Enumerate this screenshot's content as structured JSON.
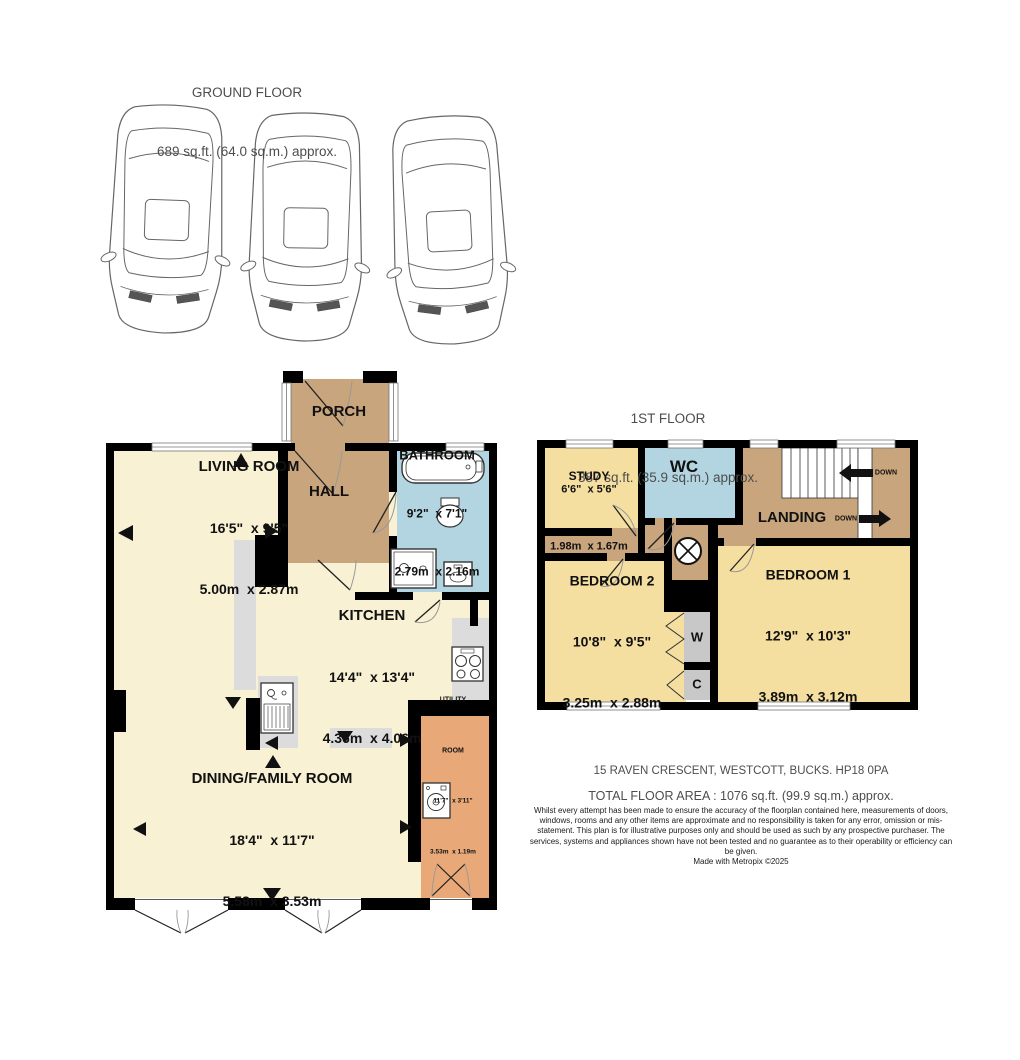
{
  "ground_floor": {
    "title": "GROUND FLOOR",
    "area_label": "689 sq.ft. (64.0 sq.m.) approx.",
    "rooms": {
      "porch": {
        "name": "PORCH"
      },
      "hall": {
        "name": "HALL"
      },
      "bathroom": {
        "name": "BATHROOM",
        "dims_imperial": "9'2\"  x 7'1\"",
        "dims_metric": "2.79m  x 2.16m"
      },
      "living_room": {
        "name": "LIVING ROOM",
        "dims_imperial": "16'5\"  x 9'5\"",
        "dims_metric": "5.00m  x 2.87m"
      },
      "kitchen": {
        "name": "KITCHEN",
        "dims_imperial": "14'4\"  x 13'4\"",
        "dims_metric": "4.36m  x 4.06m"
      },
      "dining_family_room": {
        "name": "DINING/FAMILY ROOM",
        "dims_imperial": "18'4\"  x 11'7\"",
        "dims_metric": "5.58m  x 3.53m"
      },
      "utility_room": {
        "name_line1": "UTILITY",
        "name_line2": "ROOM",
        "dims_imperial": "11'7\"  x 3'11\"",
        "dims_metric": "3.53m  x 1.19m"
      }
    }
  },
  "first_floor": {
    "title": "1ST FLOOR",
    "area_label": "387 sq.ft. (35.9 sq.m.) approx.",
    "rooms": {
      "study": {
        "name": "STUDY",
        "dims_imperial": "6'6\"  x 5'6\"",
        "dims_metric": "1.98m  x 1.67m"
      },
      "wc": {
        "name": "WC"
      },
      "landing": {
        "name": "LANDING"
      },
      "bedroom_2": {
        "name": "BEDROOM 2",
        "dims_imperial": "10'8\"  x 9'5\"",
        "dims_metric": "3.25m  x 2.88m"
      },
      "bedroom_1": {
        "name": "BEDROOM 1",
        "dims_imperial": "12'9\"  x 10'3\"",
        "dims_metric": "3.89m  x 3.12m"
      },
      "wardrobe": {
        "name": "W"
      },
      "cupboard": {
        "name": "C"
      }
    },
    "stairs": {
      "down_upper": "DOWN",
      "down_lower": "DOWN"
    }
  },
  "footer": {
    "address": "15 RAVEN CRESCENT, WESTCOTT, BUCKS. HP18 0PA",
    "total_area": "TOTAL FLOOR AREA : 1076 sq.ft. (99.9 sq.m.) approx.",
    "disclaimer": "Whilst every attempt has been made to ensure the accuracy of the floorplan contained here, measurements of doors, windows, rooms and any other items are approximate and no responsibility is taken for any error, omission or mis-statement. This plan is for illustrative purposes only and should be used as such by any prospective purchaser. The services, systems and appliances shown have not been tested and no guarantee as to their operability or efficiency can be given.",
    "credit": "Made with Metropix ©2025"
  },
  "colors": {
    "wall": "#000000",
    "cream_room": "#f8f1d3",
    "tan_room": "#c8a57d",
    "blue_room": "#b2d5e1",
    "yellow_room": "#f5dfa0",
    "orange_room": "#e8a878",
    "closet_gray": "#c8c8c8",
    "counter_gray": "#dcdcdc",
    "heading_text": "#4d4d4d",
    "label_text": "#111111"
  }
}
